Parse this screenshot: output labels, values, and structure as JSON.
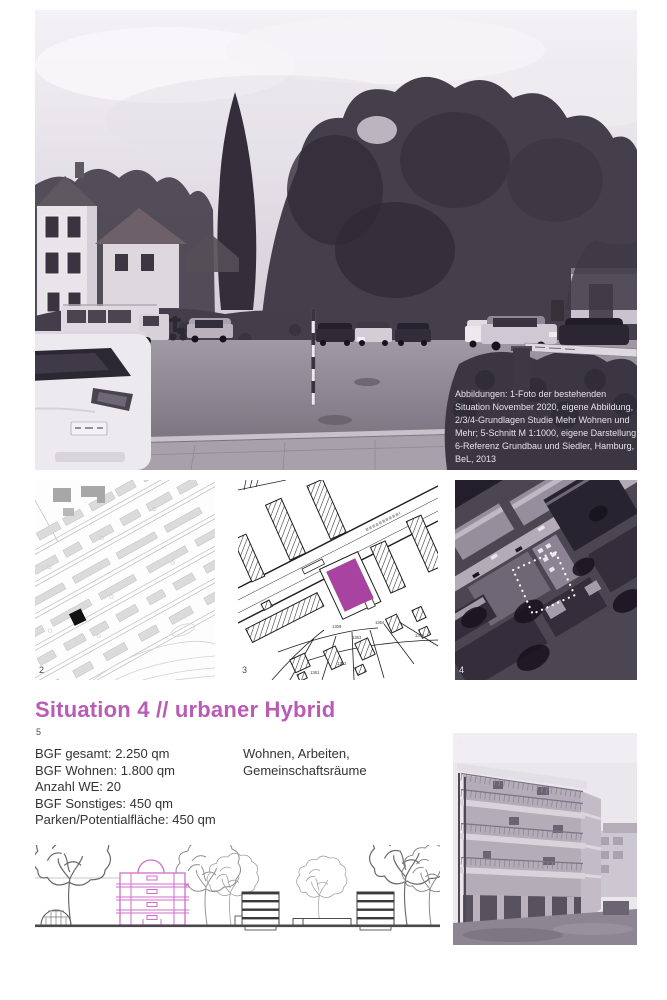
{
  "colors": {
    "accent": "#b85cb5",
    "site_fill": "#a843a2",
    "section_line": "#cf6ec8"
  },
  "heading": {
    "text": "Situation 4 // urbaner Hybrid"
  },
  "figures": {
    "photo_main": {
      "number": "1",
      "caption_lines": [
        "Abbildungen: 1-Foto der bestehenden",
        "Situation November 2020, eigene Abbildung,",
        "2/3/4-Grundlagen Studie Mehr Wohnen und",
        "Mehr; 5-Schnitt M 1:1000, eigene Darstellung;",
        "6-Referenz Grundbau und Siedler, Hamburg,",
        "BeL, 2013"
      ]
    },
    "map": {
      "number": "2"
    },
    "site_plan": {
      "number": "3",
      "parcels": [
        "1309",
        "1364",
        "1363",
        "1362",
        "1361",
        "1368"
      ]
    },
    "aerial": {
      "number": "4"
    },
    "section": {
      "number": "5"
    },
    "reference_photo": {
      "number": "6"
    }
  },
  "facts": {
    "lines": [
      "BGF gesamt: 2.250 qm",
      "BGF Wohnen: 1.800 qm",
      "Anzahl WE: 20",
      "BGF Sonstiges: 450 qm",
      "Parken/Potentialfläche: 450 qm"
    ]
  },
  "uses": {
    "lines": [
      "Wohnen, Arbeiten,",
      "Gemeinschaftsräume"
    ]
  }
}
